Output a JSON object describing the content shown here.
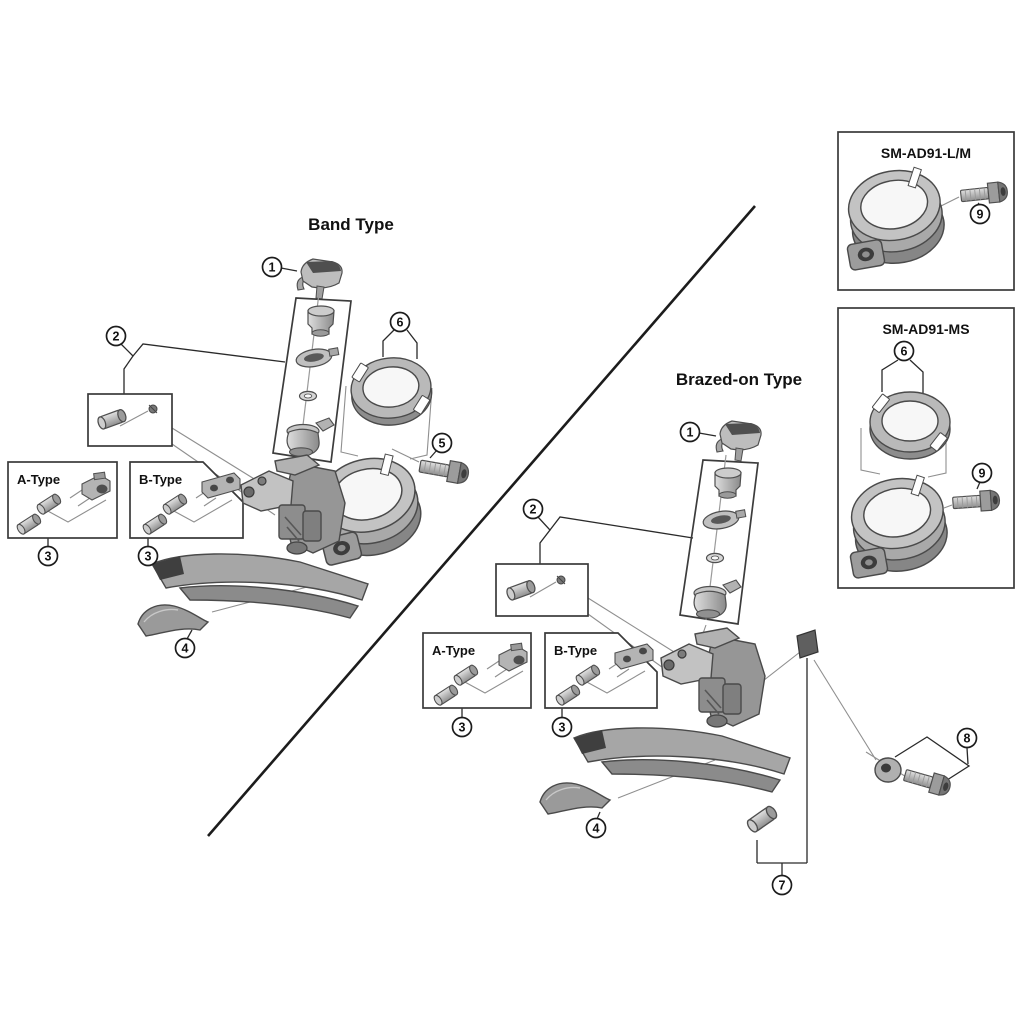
{
  "sections": {
    "band": {
      "title": "Band Type"
    },
    "brazed": {
      "title": "Brazed-on Type"
    }
  },
  "insets": {
    "lm": {
      "title": "SM-AD91-L/M"
    },
    "ms": {
      "title": "SM-AD91-MS"
    }
  },
  "type_boxes": {
    "a_left": {
      "title": "A-Type"
    },
    "b_left": {
      "title": "B-Type"
    },
    "a_right": {
      "title": "A-Type"
    },
    "b_right": {
      "title": "B-Type"
    }
  },
  "callouts": [
    {
      "id": "band-1",
      "n": "1"
    },
    {
      "id": "band-2",
      "n": "2"
    },
    {
      "id": "band-3-a",
      "n": "3"
    },
    {
      "id": "band-3-b",
      "n": "3"
    },
    {
      "id": "band-4",
      "n": "4"
    },
    {
      "id": "band-5",
      "n": "5"
    },
    {
      "id": "band-6",
      "n": "6"
    },
    {
      "id": "brazed-1",
      "n": "1"
    },
    {
      "id": "brazed-2",
      "n": "2"
    },
    {
      "id": "brazed-3-a",
      "n": "3"
    },
    {
      "id": "brazed-3-b",
      "n": "3"
    },
    {
      "id": "brazed-4",
      "n": "4"
    },
    {
      "id": "brazed-7",
      "n": "7"
    },
    {
      "id": "brazed-8",
      "n": "8"
    },
    {
      "id": "lm-9",
      "n": "9"
    },
    {
      "id": "ms-6",
      "n": "6"
    },
    {
      "id": "ms-9",
      "n": "9"
    }
  ],
  "colors": {
    "line": "#1c1c1c",
    "box_border": "#3a3a3a",
    "metal_light": "#d9d9d9",
    "metal_mid": "#a9a9a9",
    "metal_dark": "#4f4f4f"
  }
}
